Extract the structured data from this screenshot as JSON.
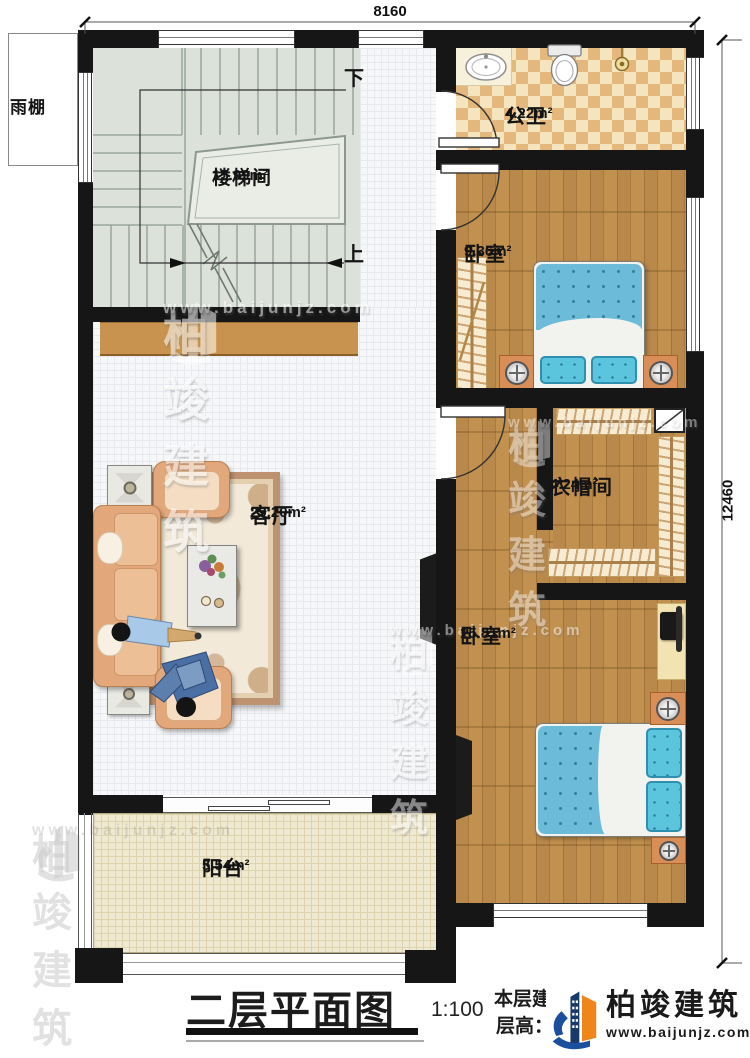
{
  "title_block": {
    "drawing_title": "二层平面图",
    "scale": "1:100",
    "area_line": "本层建筑面积：128.84m²",
    "height_line": "层高：3.3m"
  },
  "brand": {
    "name": "柏竣建筑",
    "website": "www.baijunjz.com"
  },
  "dimensions": {
    "top_width": "8160",
    "right_height": "12460"
  },
  "annotations": {
    "canopy": "雨棚",
    "stairs_down": "下",
    "stairs_up": "上"
  },
  "rooms": {
    "stairwell": {
      "name": "楼梯间",
      "area": "15.99m²"
    },
    "bathroom": {
      "name": "公卫",
      "area": "4.22m²"
    },
    "bedroom1": {
      "name": "卧室",
      "area": "9.36m²"
    },
    "cloakroom": {
      "name": "衣帽间",
      "area": "4.24m²"
    },
    "bedroom2": {
      "name": "卧室",
      "area": "15.81m²"
    },
    "living": {
      "name": "客厅",
      "area": "29.20m²"
    },
    "balcony": {
      "name": "阳台",
      "area": "5.54m²"
    }
  },
  "colors": {
    "wall": "#161616",
    "wood_floor": "#b5823f",
    "stair_floor": "#dce2da",
    "tile_cream": "#f4e5be",
    "tile_tan": "#e4b77d",
    "bed_blue": "#6cbcd9",
    "cabinet_tan": "#c8934e",
    "brand_blue": "#1c4e9e",
    "brand_orange": "#f08519"
  }
}
